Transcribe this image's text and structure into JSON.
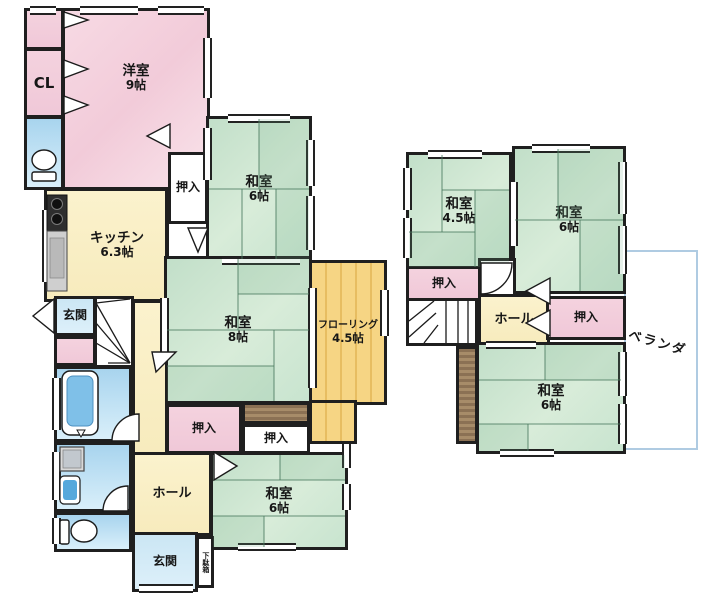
{
  "colors": {
    "wall": "#1f1f1f",
    "tatami_green": "#cde6d2",
    "western_pink": "#f5d3de",
    "closet_pink": "#f2cddb",
    "cream": "#faf0c9",
    "flooring_yellow": "#f6d483",
    "water_blue": "#bfe0f2",
    "veranda_outline": "#afcbe2",
    "wood_brown": "#8d7355"
  },
  "floor1": {
    "closet_cl": {
      "label": "CL"
    },
    "western_room": {
      "name": "洋室",
      "size": "9帖"
    },
    "kitchen": {
      "name": "キッチン",
      "size": "6.3帖"
    },
    "tatami_room_a": {
      "name": "和室",
      "size": "6帖"
    },
    "tatami_room_b": {
      "name": "和室",
      "size": "8帖"
    },
    "flooring_room": {
      "name": "フローリング",
      "size": "4.5帖"
    },
    "tatami_room_c": {
      "name": "和室",
      "size": "6帖"
    },
    "closets": [
      "押入",
      "押入",
      "押入"
    ],
    "entrance_north": "玄関",
    "entrance_south": "玄関",
    "hall": "ホール",
    "shoe_cabinet": "下駄箱"
  },
  "floor2": {
    "tatami_room_a": {
      "name": "和室",
      "size": "4.5帖"
    },
    "tatami_room_b": {
      "name": "和室",
      "size": "6帖"
    },
    "tatami_room_c": {
      "name": "和室",
      "size": "6帖"
    },
    "closets": [
      "押入",
      "押入"
    ],
    "hall": "ホール",
    "veranda": "ベランダ"
  }
}
